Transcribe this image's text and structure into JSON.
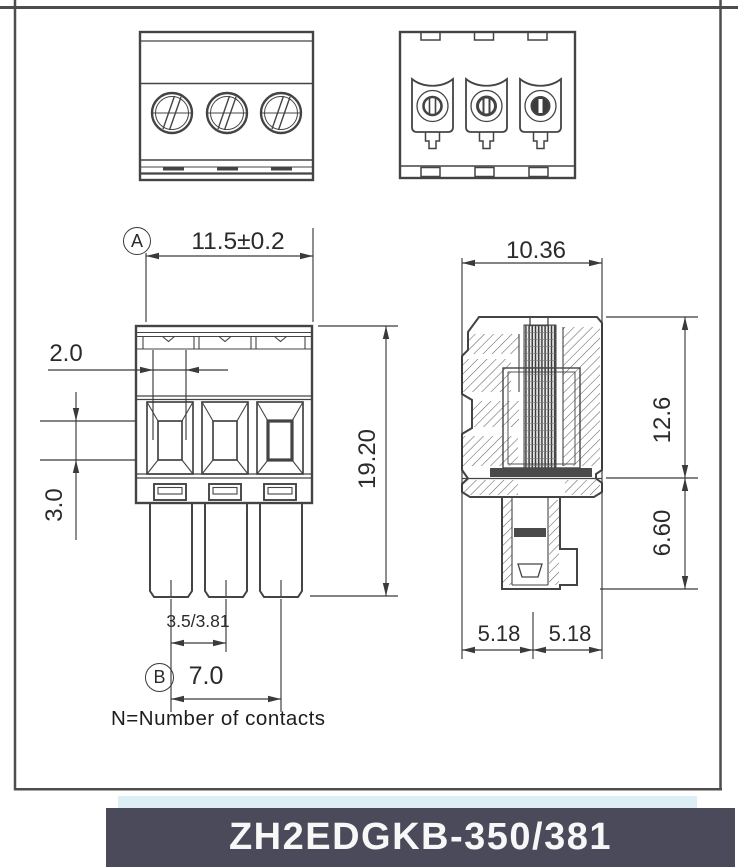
{
  "part_number": "ZH2EDGKB-350/381",
  "note": "N=Number of contacts",
  "front_view": {
    "datum_a": "A",
    "width_dim": "11.5±0.2",
    "slot_width_dim": "2.0",
    "slot_height_dim": "3.0",
    "height_dim": "19.20",
    "pitch_dim": "3.5/3.81",
    "datum_b": "B",
    "end_pitch_dim": "7.0"
  },
  "side_view": {
    "width_dim": "10.36",
    "body_height_dim": "12.6",
    "pin_length_dim": "6.60",
    "half_width_left_dim": "5.18",
    "half_width_right_dim": "5.18"
  },
  "colors": {
    "line": "#444444",
    "dimension_line": "#3a3a3a",
    "banner_bg": "#4b4a5a",
    "banner_text": "#f7f7f7",
    "strip_bg": "#ddeef4"
  }
}
